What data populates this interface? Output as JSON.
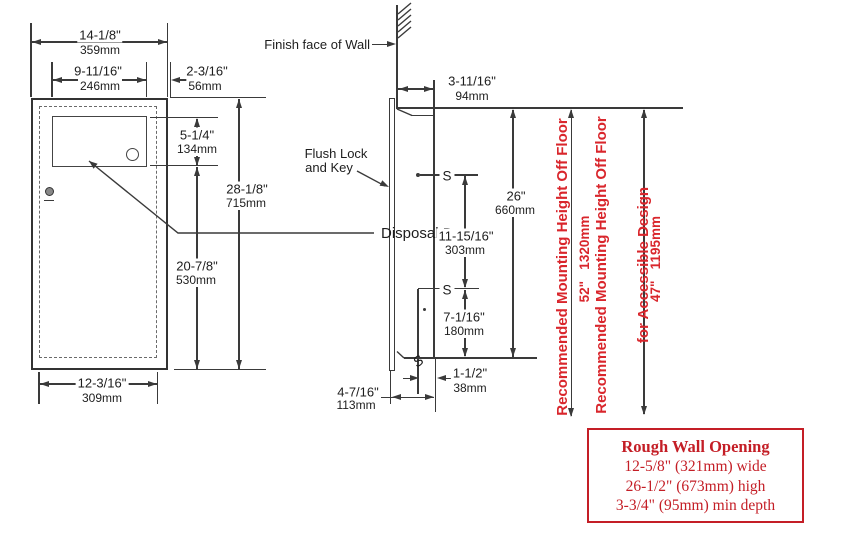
{
  "front": {
    "door_label": "Disposal Door",
    "w_top_in": "14-1/8\"",
    "w_top_mm": "359mm",
    "door_w_in": "9-11/16\"",
    "door_w_mm": "246mm",
    "offset_in": "2-3/16\"",
    "offset_mm": "56mm",
    "door_h_in": "5-1/4\"",
    "door_h_mm": "134mm",
    "height_in": "28-1/8\"",
    "height_mm": "715mm",
    "lower_in": "20-7/8\"",
    "lower_mm": "530mm",
    "w_bot_in": "12-3/16\"",
    "w_bot_mm": "309mm"
  },
  "side": {
    "wall_label": "Finish face of Wall",
    "lock_label_1": "Flush Lock",
    "lock_label_2": "and Key",
    "depth_in": "3-11/16\"",
    "depth_mm": "94mm",
    "open_h_in": "26\"",
    "open_h_mm": "660mm",
    "stud_in": "11-15/16\"",
    "stud_mm": "303mm",
    "stud2_in": "7-1/16\"",
    "stud2_mm": "180mm",
    "inset_in": "1-1/2\"",
    "inset_mm": "38mm",
    "depth_bot_in": "4-7/16\"",
    "depth_bot_mm": "113mm",
    "s1": "S",
    "s2": "S",
    "s3": "S"
  },
  "mounting": {
    "std_label": "Recommended Mounting Height Off Floor",
    "std_value": "52\"   1320mm",
    "ada_label_1": "Recommended Mounting Height Off Floor",
    "ada_label_2": "for Accessible Design",
    "ada_value": "47\"   1195mm"
  },
  "rough_opening": {
    "title": "Rough Wall Opening",
    "rows": [
      "12-5/8\" (321mm) wide",
      "26-1/2\" (673mm) high",
      "3-3/4\" (95mm) min depth"
    ]
  },
  "colors": {
    "line": "#3a3a3a",
    "red_dimension_text": "#d9262c",
    "red_box": "#c41e26",
    "background": "#ffffff"
  }
}
